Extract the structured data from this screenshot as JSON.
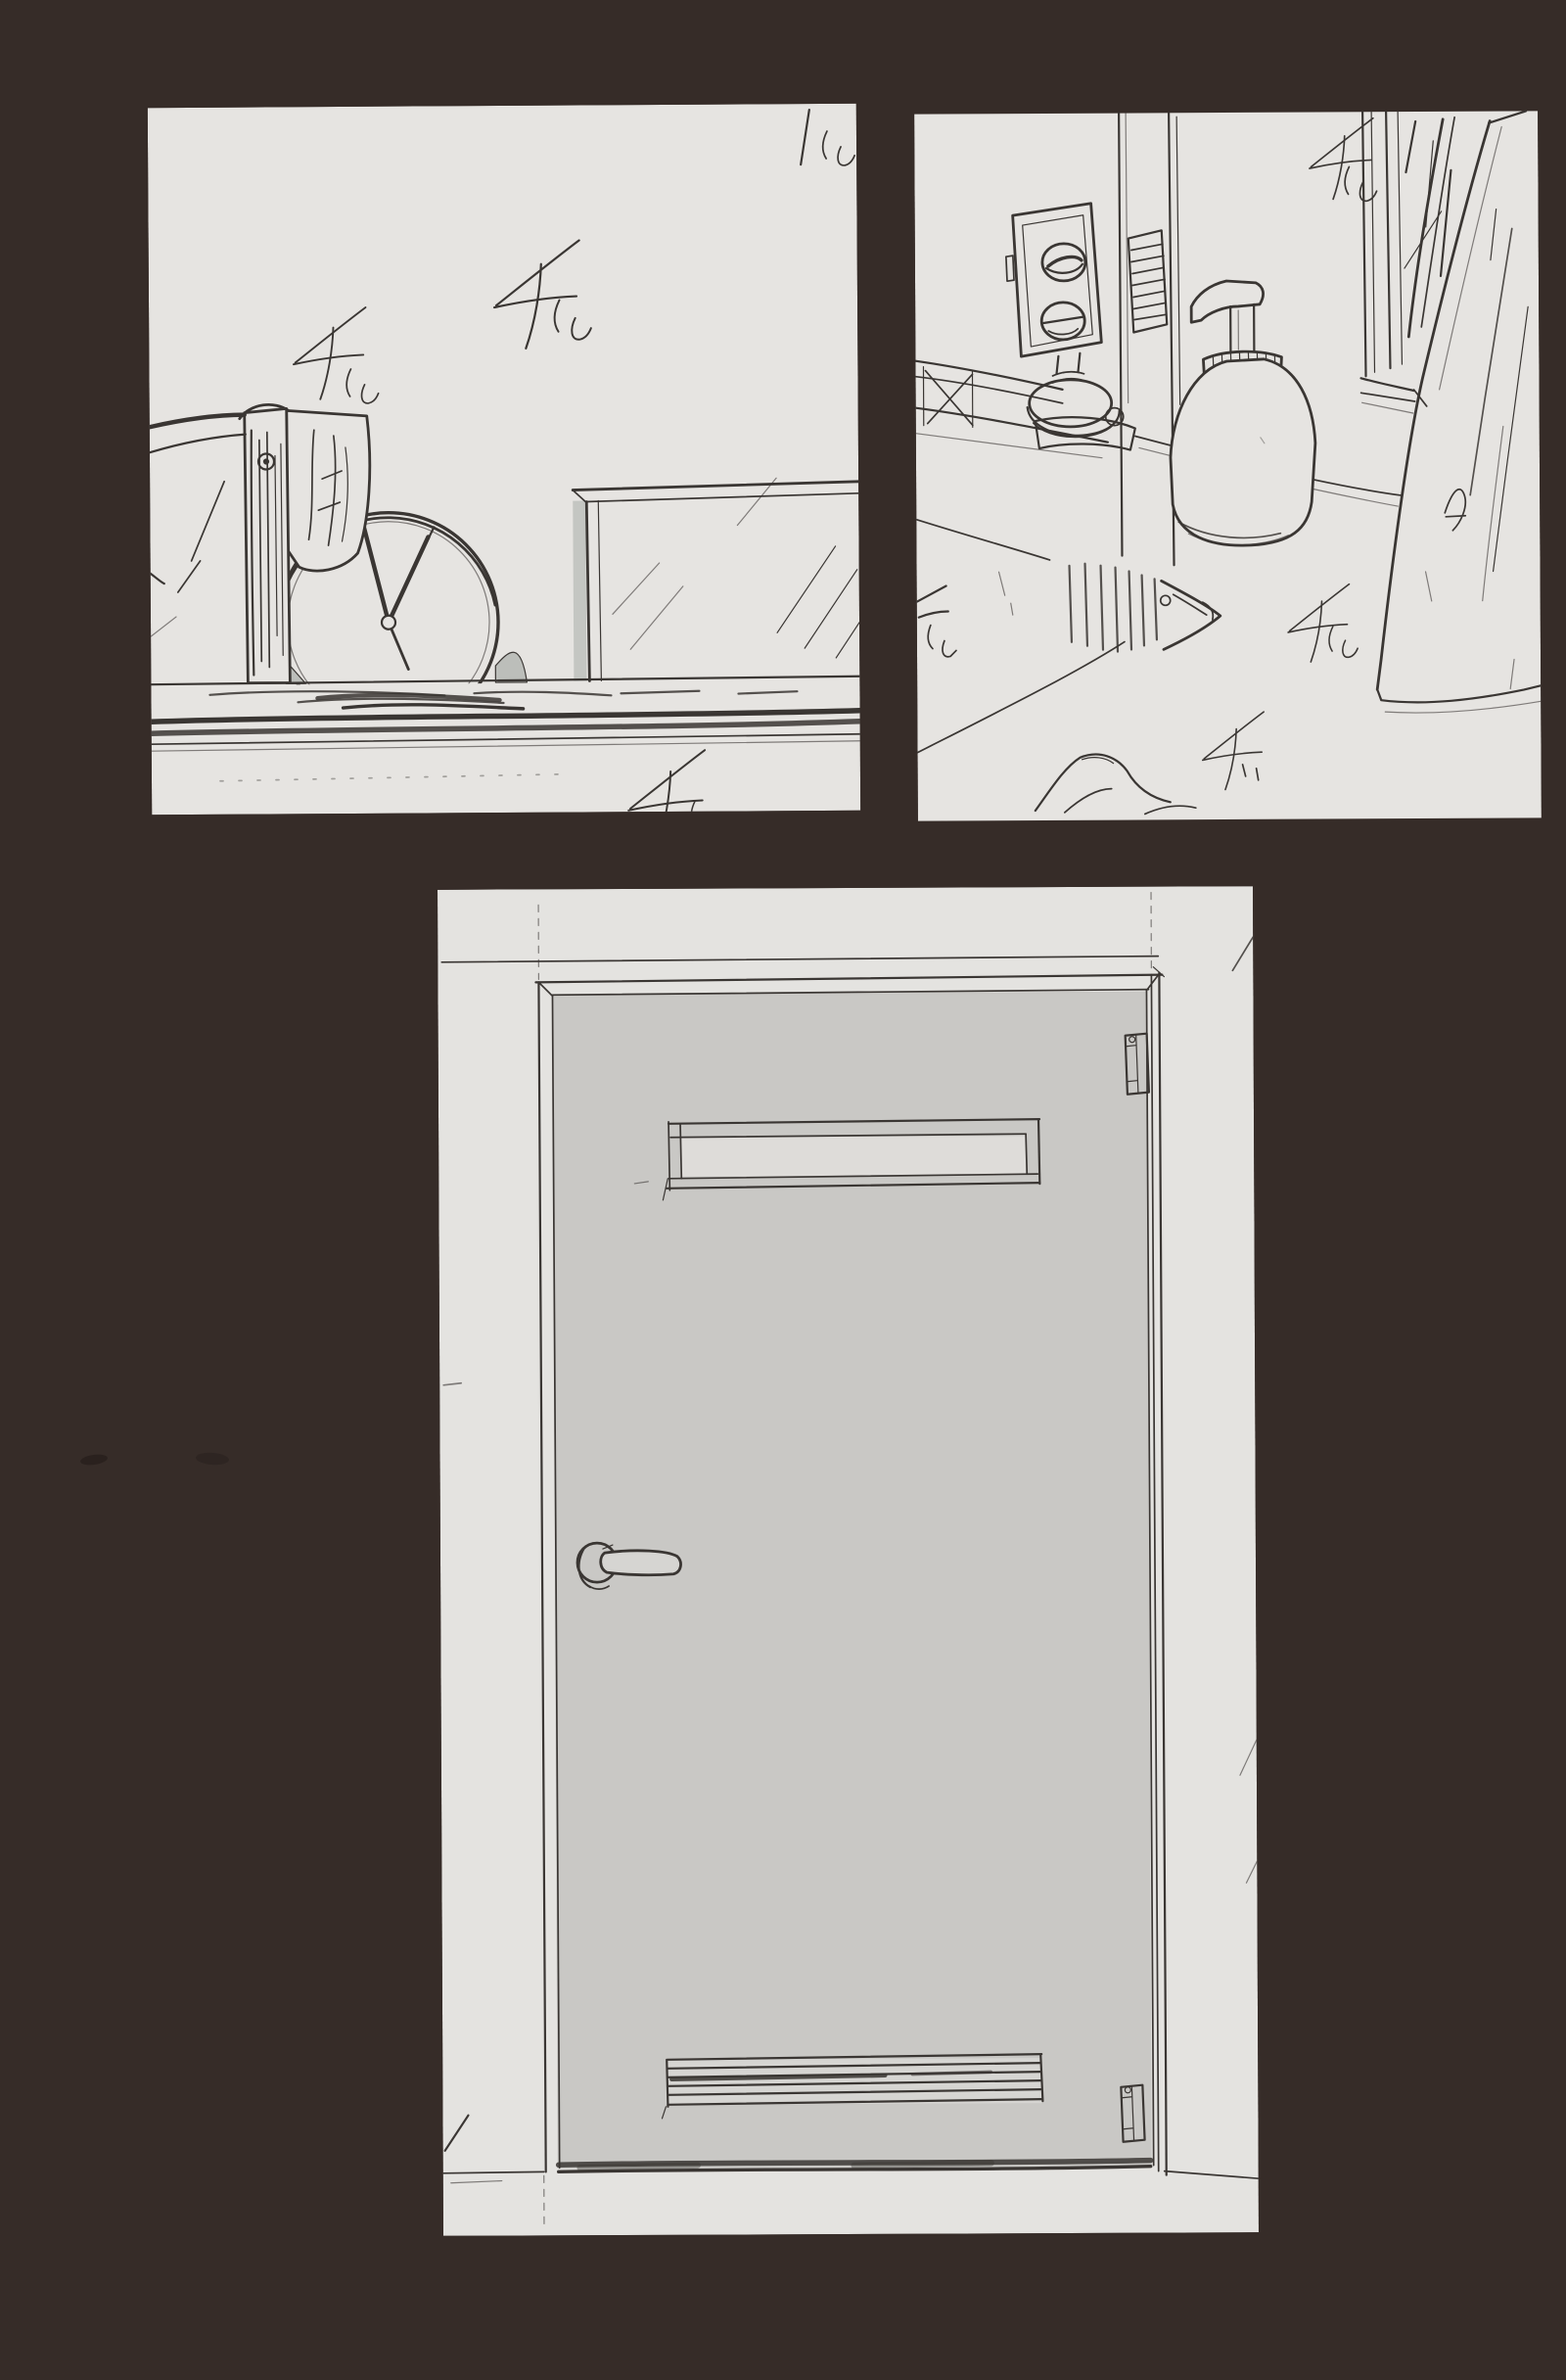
{
  "page": {
    "kind": "scanned sketchbook page with three pencil background-study panels",
    "panel_count": 3
  },
  "colors": {
    "background": "#362c28",
    "paper": "#e6e4e1",
    "paper_door": "#e4e3e0",
    "door_gray": "#c9c8c5",
    "slot_white": "#dedcd9",
    "vent_white": "#d6d5d2",
    "tone_gray": "#bcbeba",
    "pencil": "#3a3633"
  },
  "panels": [
    {
      "id": "clock-shelf",
      "subject": "round clock on a shelf beside a towel post and a glass-top table",
      "clock_time_depicted": "about 11:05"
    },
    {
      "id": "washstand",
      "subject": "washstand corner: wall mixer unit, soap pump bottle, window and leaning mirror, drain on counter"
    },
    {
      "id": "door",
      "subject": "door study: transom slot, lever handle, louvered vent, two hinges"
    }
  ]
}
